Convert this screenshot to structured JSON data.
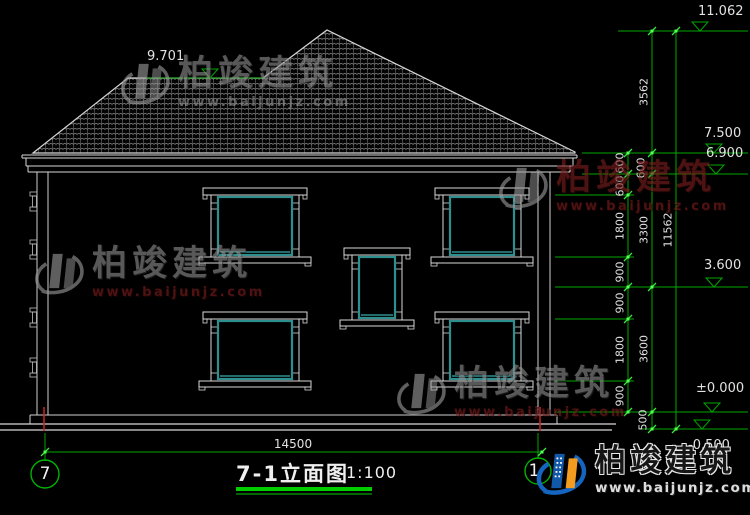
{
  "drawing": {
    "title": "7-1立面图",
    "scale": "1:100",
    "axis_bubbles": {
      "left": "7",
      "right": "1"
    },
    "bottom_width_dim": "14500",
    "roof_left_elevation": "9.701",
    "elevation_marks": {
      "ridge": "11.062",
      "eave_top": "7.500",
      "eave_bottom": "6.900",
      "second_floor": "3.600",
      "ground_floor": "±0.000",
      "site_ground": "-0.500"
    },
    "right_dims_inner": [
      "600",
      "600",
      "1800",
      "900",
      "900",
      "1800",
      "900"
    ],
    "right_dims_middle": [
      "3562",
      "600",
      "3300",
      "3600",
      "500"
    ],
    "right_dims_overall": "11562"
  },
  "watermark": {
    "brand": "柏竣建筑",
    "url": "www.baijunjz.com"
  },
  "logo": {
    "brand": "柏竣建筑",
    "url": "www.baijunjz.com"
  },
  "colors": {
    "cad_green": "#00a800",
    "tick_green": "#39e639",
    "window_teal": "#2e8f8f",
    "axis_red": "#cc2222",
    "brand_red": "#7c1d1d",
    "logo_blue": "#1565c0",
    "logo_orange": "#f39c1f",
    "underline_green": "#00cc00"
  }
}
